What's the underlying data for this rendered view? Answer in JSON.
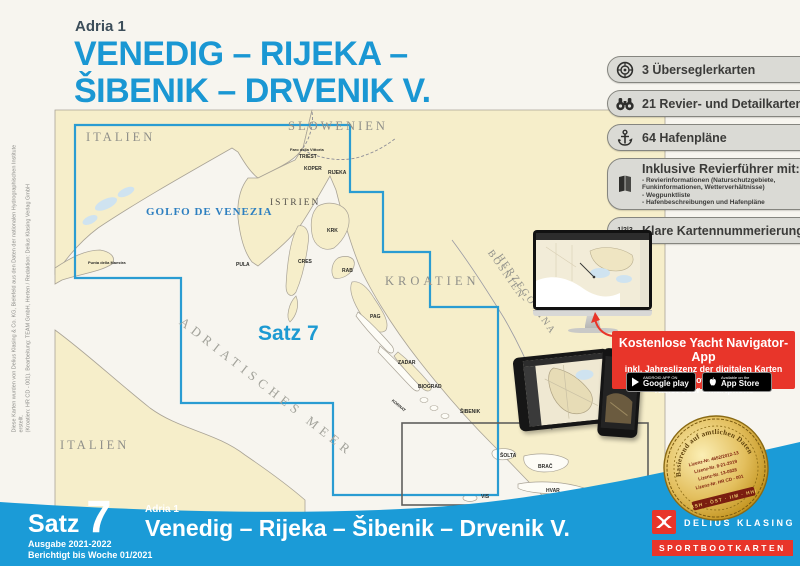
{
  "colors": {
    "accent_cyan": "#1a97d3",
    "footer_blue": "#1b9bd7",
    "brand_red": "#e8352a",
    "map_land": "#f6eeca",
    "chart_boundary": "#2a9cd2",
    "gold": "#e3bf5e"
  },
  "side_note": {
    "line1": "Diese Karten wurden von Delius Klasing & Co. KG, Bielefeld aus den Daten der nationalen Hydrographischen Institute erstellt.",
    "line2": "(Kroatien: HR CD - 001). Bearbeitung: TEAM GmbH, Herten / Redaktion: Delius Klasing Verlag GmbH"
  },
  "header": {
    "series": "Adria 1",
    "title_line1": "VENEDIG – RIJEKA –",
    "title_line2": "ŠIBENIK – DRVENIK V."
  },
  "features": [
    {
      "icon": "compass-chart-icon",
      "label": "3 Überseglerkarten"
    },
    {
      "icon": "binoculars-icon",
      "label": "21 Revier- und Detailkarten"
    },
    {
      "icon": "anchor-icon",
      "label": "64 Hafenpläne"
    },
    {
      "icon": "book-icon",
      "label": "Inklusive Revierführer mit:",
      "details": [
        "- Revierinformationen (Naturschutzgebiete,",
        "  Funkinformationen, Wetterverhältnisse)",
        "- Wegpunktliste",
        "- Hafenbeschreibungen und Hafenpläne"
      ]
    },
    {
      "icon": "numbers-123-icon",
      "label": "Klare Kartennummerierung",
      "icon_text": "1|2|3"
    }
  ],
  "map": {
    "set_label": "Satz 7",
    "regions": {
      "italien_north": "ITALIEN",
      "slowenien": "SLOWENIEN",
      "italien_south": "ITALIEN",
      "kroatien": "KROATIEN",
      "bosnien": "BOSNIEN-",
      "herzegowina": "HERZEGOWINA",
      "istrien": "ISTRIEN"
    },
    "sea": {
      "golfo": "GOLFO DE VENEZIA",
      "adria": "ADRIATISCHES MEER"
    },
    "places": {
      "faro": "Faro della Vittoria",
      "triest": "TRIEST",
      "koper": "KOPER",
      "rijeka": "RIJEKA",
      "pula": "PULA",
      "krk": "KRK",
      "cres": "CRES",
      "rab": "RAB",
      "pag": "PAG",
      "zadar": "ZADAR",
      "biograd": "BIOGRAD",
      "sibenik": "ŠIBENIK",
      "kornat": "KORNAT",
      "brac": "BRAČ",
      "hvar": "HVAR",
      "solta": "ŠOLTA",
      "vis": "VIS",
      "punta": "Punta della Maestra"
    }
  },
  "app_promo": {
    "title": "Kostenlose Yacht Navigator-App",
    "line1": "inkl. Jahreslizenz der digitalen Karten",
    "line2": "für PC (Windows 7-10, 64bit),",
    "line3": "Tablet oder Smartphone",
    "google_badge": {
      "line1": "ANDROID APP ON",
      "line2": "Google play"
    },
    "apple_badge": {
      "line1": "Available on the",
      "line2": "App Store"
    }
  },
  "seal": {
    "ring_text": "Basierend auf amtlichen Daten",
    "license_lines": [
      "Lizenz-Nr. 4652/2012-13",
      "Lizenz-Nr. 8-21-2019",
      "Lizenz-Nr. 13-0828",
      "Lizenz-Nr. HR CD - 001"
    ],
    "banner": "BSH · ÖST · IIM · HHI"
  },
  "footer": {
    "set_word": "Satz",
    "set_number": "7",
    "edition": "Ausgabe 2021-2022",
    "corrected": "Berichtigt bis Woche 01/2021",
    "series": "Adria 1",
    "title": "Venedig – Rijeka – Šibenik – Drvenik V.",
    "publisher": "DELIUS KLASING",
    "product_line": "SPORTBOOTKARTEN"
  }
}
